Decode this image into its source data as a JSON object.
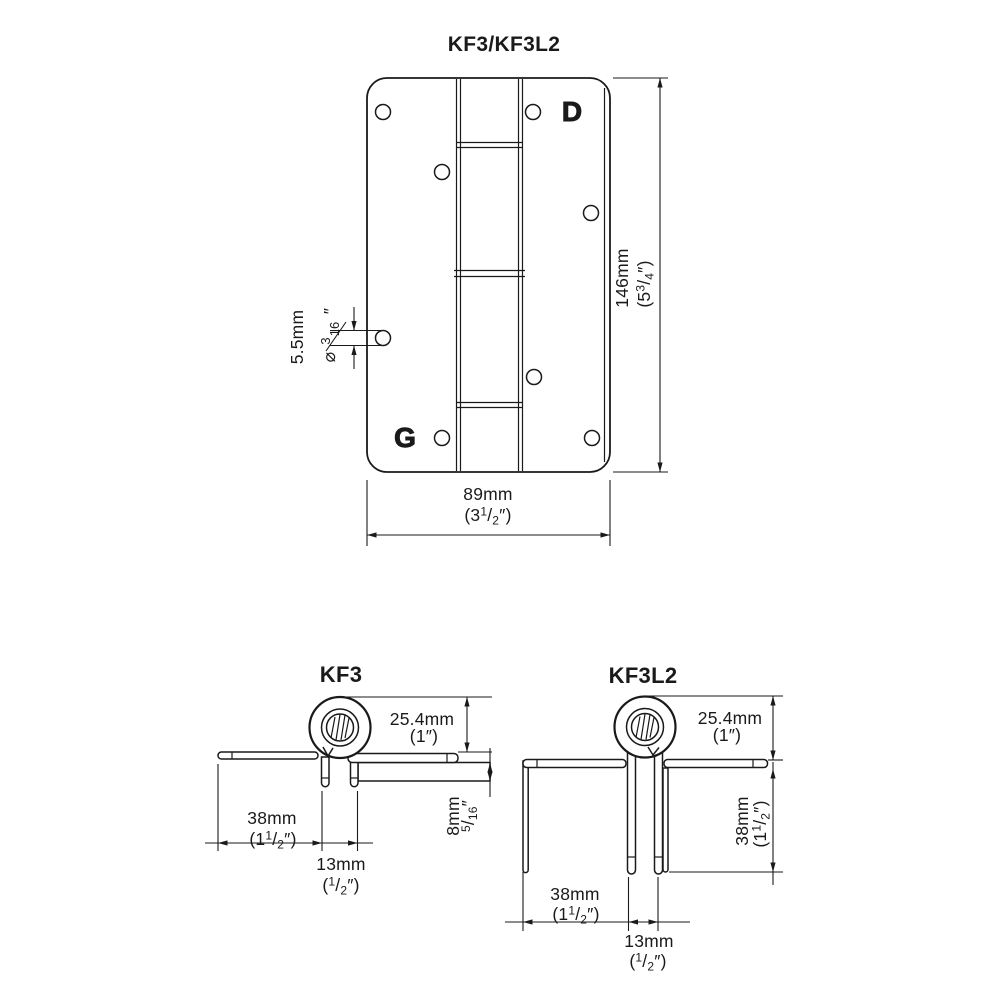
{
  "front": {
    "title": "KF3/KF3L2",
    "logo_d": "D",
    "logo_g": "G",
    "height": {
      "mm": "146mm",
      "in_pre": "(5",
      "in_num": "3",
      "in_den": "4",
      "in_post": "″)"
    },
    "width": {
      "mm": "89mm",
      "in_pre": "(3",
      "in_num": "1",
      "in_den": "2",
      "in_post": "″)"
    },
    "hole": {
      "mm": "5.5mm",
      "dia": "⌀",
      "num": "3",
      "den": "16",
      "post": "″"
    }
  },
  "kf3": {
    "title": "KF3",
    "knuckle": {
      "mm": "25.4mm",
      "in": "(1″)"
    },
    "leaf": {
      "mm": "38mm",
      "in_pre": "(1",
      "in_num": "1",
      "in_den": "2",
      "in_post": "″)"
    },
    "kerf": {
      "mm": "13mm",
      "in_pre": "(",
      "in_num": "1",
      "in_den": "2",
      "in_post": "″)"
    },
    "thickness": {
      "mm": "8mm",
      "num": "5",
      "den": "16",
      "post": "″"
    }
  },
  "kf3l2": {
    "title": "KF3L2",
    "knuckle": {
      "mm": "25.4mm",
      "in": "(1″)"
    },
    "skirt": {
      "mm": "38mm",
      "in_pre": "(1",
      "in_num": "1",
      "in_den": "2",
      "in_post": "″)"
    },
    "leaf": {
      "mm": "38mm",
      "in_pre": "(1",
      "in_num": "1",
      "in_den": "2",
      "in_post": "″)"
    },
    "kerf": {
      "mm": "13mm",
      "in_pre": "(",
      "in_num": "1",
      "in_den": "2",
      "in_post": "″)"
    }
  },
  "colors": {
    "line": "#1a1a1a",
    "background": "#ffffff"
  }
}
